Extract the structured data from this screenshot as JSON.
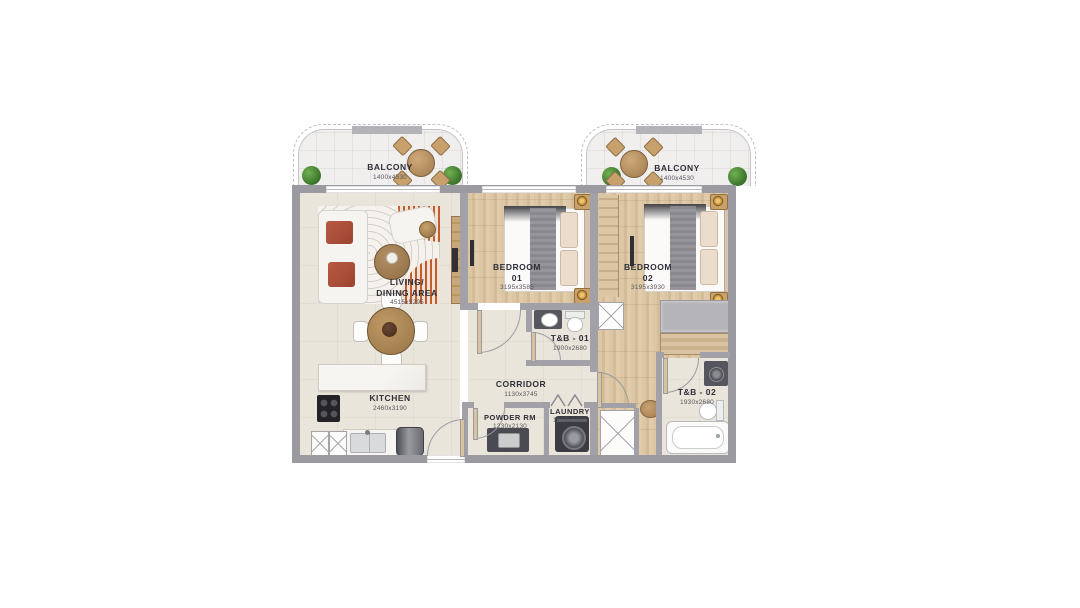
{
  "meta": {
    "type": "residential floor plan",
    "unit": "two-bedroom apartment with two balconies"
  },
  "colors": {
    "wall": "#a1a1a7",
    "floor_cream": "#eae5da",
    "floor_wood": "#d8c19e",
    "balcony_floor": "#f0efed",
    "sofa_cushion_red": "#ad4f3a",
    "rug_orange": "#c05c2e",
    "plant_green": "#3f7a2e",
    "label_text": "#2e2f38",
    "dim_text": "#565761"
  },
  "rooms": {
    "balcony_left": {
      "line1": "BALCONY",
      "dims": "1400x4530"
    },
    "balcony_right": {
      "line1": "BALCONY",
      "dims": "1400x4530"
    },
    "living": {
      "line1": "LIVING/",
      "line2": "DINING AREA",
      "dims": "4515x5295"
    },
    "bedroom1": {
      "line1": "BEDROOM",
      "line2": "01",
      "dims": "3195x3585"
    },
    "bedroom2": {
      "line1": "BEDROOM",
      "line2": "02",
      "dims": "3195x3930"
    },
    "tb1": {
      "line1": "T&B - 01",
      "dims": "1900x2680"
    },
    "tb2": {
      "line1": "T&B - 02",
      "dims": "1930x2680"
    },
    "corridor": {
      "line1": "CORRIDOR",
      "dims": "1130x3745"
    },
    "kitchen": {
      "line1": "KITCHEN",
      "dims": "2460x3190"
    },
    "powder": {
      "line1": "POWDER RM",
      "dims": "1230x2130"
    },
    "laundry": {
      "line1": "LAUNDRY",
      "dims": "1215x1230"
    }
  },
  "furniture": {
    "living": [
      "l-sofa",
      "area-rug",
      "coffee-table",
      "lounge-chair",
      "side-table",
      "tv-console",
      "dining-table",
      "dining-chairs"
    ],
    "kitchen": [
      "island-counter",
      "stove",
      "sink",
      "refrigerator",
      "base-cabinets"
    ],
    "bedroom1": [
      "double-bed",
      "nightstands",
      "lamps",
      "tv"
    ],
    "bedroom2": [
      "double-bed",
      "nightstands",
      "lamps",
      "wardrobe",
      "tv",
      "stool"
    ],
    "tb1": [
      "vanity",
      "toilet"
    ],
    "tb2": [
      "vanity",
      "toilet",
      "bathtub"
    ],
    "powder": [
      "vanity"
    ],
    "laundry": [
      "washing-machine"
    ],
    "balconies": [
      "round-table",
      "chairs",
      "plants"
    ]
  }
}
